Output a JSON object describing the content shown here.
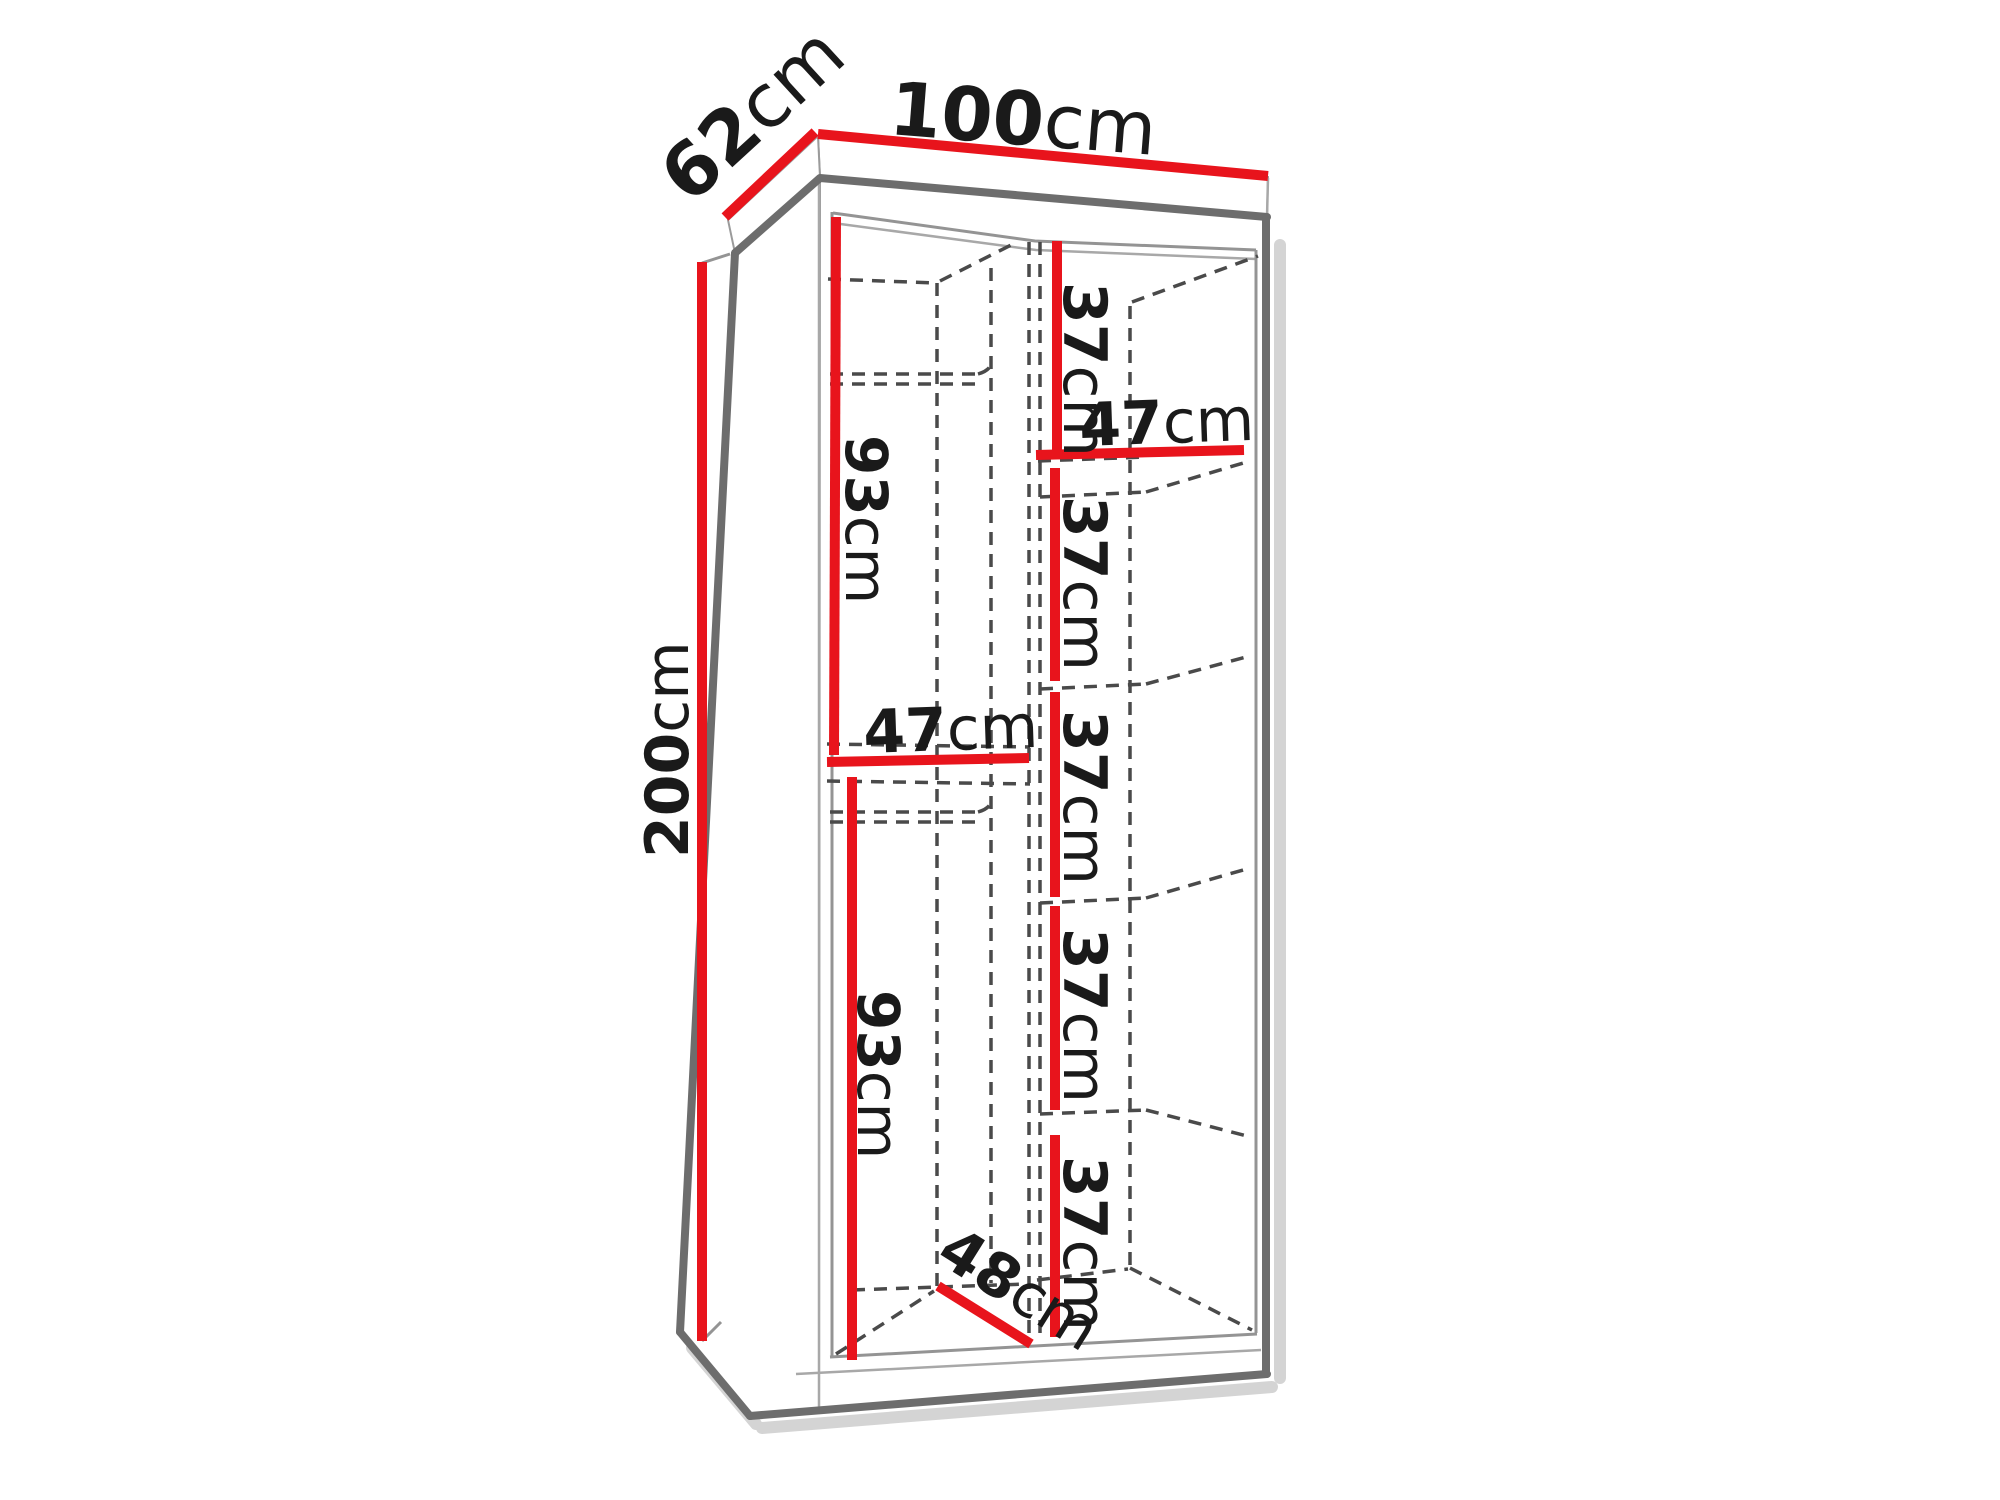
{
  "colors": {
    "dimension_line": "#e8141c",
    "outline": "#6d6d6d",
    "hidden_edge": "#4a4a4a",
    "label_text": "#1a1a1a",
    "background": "#ffffff"
  },
  "dimensions": {
    "width": {
      "value": "100",
      "unit": "cm"
    },
    "depth": {
      "value": "62",
      "unit": "cm"
    },
    "height": {
      "value": "200",
      "unit": "cm"
    },
    "left_top_section_height": {
      "value": "93",
      "unit": "cm"
    },
    "left_shelf_width": {
      "value": "47",
      "unit": "cm"
    },
    "left_bottom_section_height": {
      "value": "93",
      "unit": "cm"
    },
    "interior_depth": {
      "value": "48",
      "unit": "cm"
    },
    "right_top_shelf_width": {
      "value": "47",
      "unit": "cm"
    },
    "right_shelf_heights": [
      {
        "value": "37",
        "unit": "cm"
      },
      {
        "value": "37",
        "unit": "cm"
      },
      {
        "value": "37",
        "unit": "cm"
      },
      {
        "value": "37",
        "unit": "cm"
      },
      {
        "value": "37",
        "unit": "cm"
      }
    ]
  }
}
